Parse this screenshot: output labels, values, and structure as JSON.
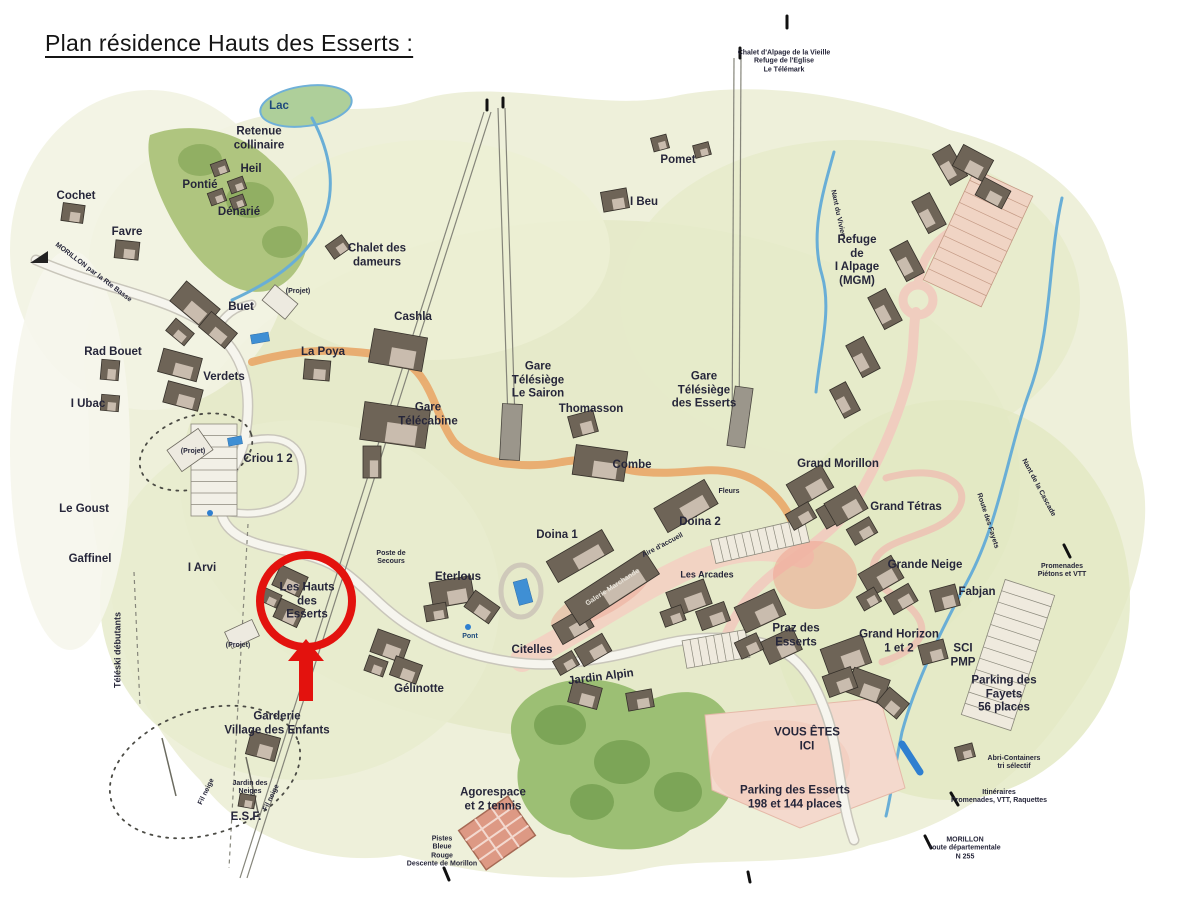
{
  "page": {
    "title": "Plan résidence Hauts des Esserts :"
  },
  "map": {
    "colors": {
      "highlight": "#e3120e",
      "water": "#69aed6",
      "terrain": "#eef0da",
      "forest": "#a9c077",
      "road_orange": "#e9a768",
      "road_pink": "#f0cdbf",
      "parking_pink": "#f4d9cd",
      "label_ink": "#26263a"
    },
    "highlight": {
      "target": "Les Hauts des Esserts"
    },
    "labels": [
      {
        "t": "Lac",
        "x": 279,
        "y": 107,
        "cls": "md",
        "c": "#1e4a7c"
      },
      {
        "t": "Retenue\ncollinaire",
        "x": 259,
        "y": 139,
        "cls": "md"
      },
      {
        "t": "Heil",
        "x": 251,
        "y": 170,
        "cls": "md"
      },
      {
        "t": "Pontié",
        "x": 200,
        "y": 186,
        "cls": "md"
      },
      {
        "t": "Dénarié",
        "x": 239,
        "y": 213,
        "cls": "md"
      },
      {
        "t": "Cochet",
        "x": 76,
        "y": 197,
        "cls": "md"
      },
      {
        "t": "Favre",
        "x": 127,
        "y": 233,
        "cls": "md"
      },
      {
        "t": "Pomet",
        "x": 678,
        "y": 161,
        "cls": "md"
      },
      {
        "t": "I Beu",
        "x": 644,
        "y": 203,
        "cls": "md"
      },
      {
        "t": "Chalet des\ndameurs",
        "x": 377,
        "y": 256,
        "cls": "md"
      },
      {
        "t": "Buet",
        "x": 241,
        "y": 308,
        "cls": "md"
      },
      {
        "t": "Rad Bouet",
        "x": 113,
        "y": 353,
        "cls": "md"
      },
      {
        "t": "Verdets",
        "x": 224,
        "y": 378,
        "cls": "md"
      },
      {
        "t": "I Ubac",
        "x": 88,
        "y": 405,
        "cls": "md"
      },
      {
        "t": "La Poya",
        "x": 323,
        "y": 353,
        "cls": "md"
      },
      {
        "t": "(Projet)",
        "x": 298,
        "y": 292,
        "cls": "xs"
      },
      {
        "t": "(Projet)",
        "x": 193,
        "y": 452,
        "cls": "xs"
      },
      {
        "t": "(Projet)",
        "x": 238,
        "y": 646,
        "cls": "xs"
      },
      {
        "t": "Criou 1 2",
        "x": 268,
        "y": 460,
        "cls": "md"
      },
      {
        "t": "Cashla",
        "x": 413,
        "y": 318,
        "cls": "md"
      },
      {
        "t": "Gare\nTélécabine",
        "x": 428,
        "y": 415,
        "cls": "md"
      },
      {
        "t": "Gare\nTélésiège\nLe Sairon",
        "x": 538,
        "y": 381,
        "cls": "md"
      },
      {
        "t": "Thomasson",
        "x": 591,
        "y": 410,
        "cls": "md"
      },
      {
        "t": "Gare\nTélésiège\ndes Esserts",
        "x": 704,
        "y": 391,
        "cls": "md"
      },
      {
        "t": "Combe",
        "x": 632,
        "y": 466,
        "cls": "md"
      },
      {
        "t": "Doina 1",
        "x": 557,
        "y": 536,
        "cls": "md"
      },
      {
        "t": "Doina 2",
        "x": 700,
        "y": 523,
        "cls": "md"
      },
      {
        "t": "Grand Morillon",
        "x": 838,
        "y": 465,
        "cls": "md"
      },
      {
        "t": "Refuge\nde\nI Alpage\n(MGM)",
        "x": 857,
        "y": 261,
        "cls": "md"
      },
      {
        "t": "Grand Tétras",
        "x": 906,
        "y": 508,
        "cls": "md"
      },
      {
        "t": "Grande Neige",
        "x": 925,
        "y": 566,
        "cls": "md"
      },
      {
        "t": "Fabjan",
        "x": 977,
        "y": 593,
        "cls": "md"
      },
      {
        "t": "Grand Horizon\n1 et 2",
        "x": 899,
        "y": 642,
        "cls": "md"
      },
      {
        "t": "SCI\nPMP",
        "x": 963,
        "y": 656,
        "cls": "md"
      },
      {
        "t": "Praz des\nEsserts",
        "x": 796,
        "y": 636,
        "cls": "md"
      },
      {
        "t": "Les Arcades",
        "x": 707,
        "y": 575,
        "cls": "sm"
      },
      {
        "t": "Eterlous",
        "x": 458,
        "y": 578,
        "cls": "md"
      },
      {
        "t": "Citelles",
        "x": 532,
        "y": 651,
        "cls": "md"
      },
      {
        "t": "Jardin Alpin",
        "x": 601,
        "y": 678,
        "cls": "md",
        "r": -7
      },
      {
        "t": "Gélinotte",
        "x": 419,
        "y": 690,
        "cls": "md"
      },
      {
        "t": "Garderie\nVillage des Enfants",
        "x": 277,
        "y": 724,
        "cls": "md"
      },
      {
        "t": "Jardin des\nNeiges",
        "x": 250,
        "y": 788,
        "cls": "xs"
      },
      {
        "t": "E.S.F.",
        "x": 246,
        "y": 818,
        "cls": "md"
      },
      {
        "t": "Fil neige",
        "x": 207,
        "y": 792,
        "cls": "xs",
        "r": -64
      },
      {
        "t": "Fil neige",
        "x": 272,
        "y": 798,
        "cls": "xs",
        "r": -64
      },
      {
        "t": "Les Hauts\ndes\nEsserts",
        "x": 307,
        "y": 602,
        "cls": "md"
      },
      {
        "t": "Agorespace\net 2 tennis",
        "x": 493,
        "y": 800,
        "cls": "md"
      },
      {
        "t": "Pistes\nBleue\nRouge\nDescente de Morillon",
        "x": 442,
        "y": 852,
        "cls": "xs"
      },
      {
        "t": "VOUS ÊTES\nICI",
        "x": 807,
        "y": 740,
        "cls": "md"
      },
      {
        "t": "Parking des Esserts\n198 et 144 places",
        "x": 795,
        "y": 798,
        "cls": "md"
      },
      {
        "t": "Parking des\nFayets\n56 places",
        "x": 1004,
        "y": 695,
        "cls": "md"
      },
      {
        "t": "Abri-Containers\ntri sélectif",
        "x": 1014,
        "y": 763,
        "cls": "xs"
      },
      {
        "t": "Itinéraires\nPromenades, VTT, Raquettes",
        "x": 999,
        "y": 797,
        "cls": "xs"
      },
      {
        "t": "MORILLON\nroute départementale\nN 255",
        "x": 965,
        "y": 849,
        "cls": "xs"
      },
      {
        "t": "Le Goust",
        "x": 84,
        "y": 510,
        "cls": "md"
      },
      {
        "t": "Gaffinel",
        "x": 90,
        "y": 560,
        "cls": "md"
      },
      {
        "t": "I Arvi",
        "x": 202,
        "y": 569,
        "cls": "md"
      },
      {
        "t": "Téléski débutants",
        "x": 118,
        "y": 650,
        "cls": "sm",
        "r": -90
      },
      {
        "t": "Chalet d'Alpage de la Vieille\nRefuge de l'Eglise\nLe Télémark",
        "x": 784,
        "y": 62,
        "cls": "xs"
      },
      {
        "t": "Poste de\nSecours",
        "x": 391,
        "y": 558,
        "cls": "xs"
      },
      {
        "t": "Pont",
        "x": 470,
        "y": 637,
        "cls": "xs",
        "c": "#1e4a7c"
      },
      {
        "t": "MORILLON par la Rte Basse",
        "x": 93,
        "y": 273,
        "cls": "xs",
        "r": 37
      },
      {
        "t": "Nant du Vivier",
        "x": 837,
        "y": 213,
        "cls": "xs",
        "r": 78
      },
      {
        "t": "Route des Fayets",
        "x": 987,
        "y": 521,
        "cls": "xs",
        "r": 72
      },
      {
        "t": "Nant de la Cascade",
        "x": 1038,
        "y": 488,
        "cls": "xs",
        "r": 62
      },
      {
        "t": "Promenades\nPiétons et VTT",
        "x": 1062,
        "y": 571,
        "cls": "xs"
      },
      {
        "t": "Galerie Marchande",
        "x": 613,
        "y": 588,
        "cls": "xs",
        "r": -33,
        "c": "#e8e4da"
      },
      {
        "t": "Fleurs",
        "x": 729,
        "y": 492,
        "cls": "xs"
      },
      {
        "t": "Aire d'accueil",
        "x": 663,
        "y": 546,
        "cls": "xs",
        "r": -28
      }
    ]
  }
}
